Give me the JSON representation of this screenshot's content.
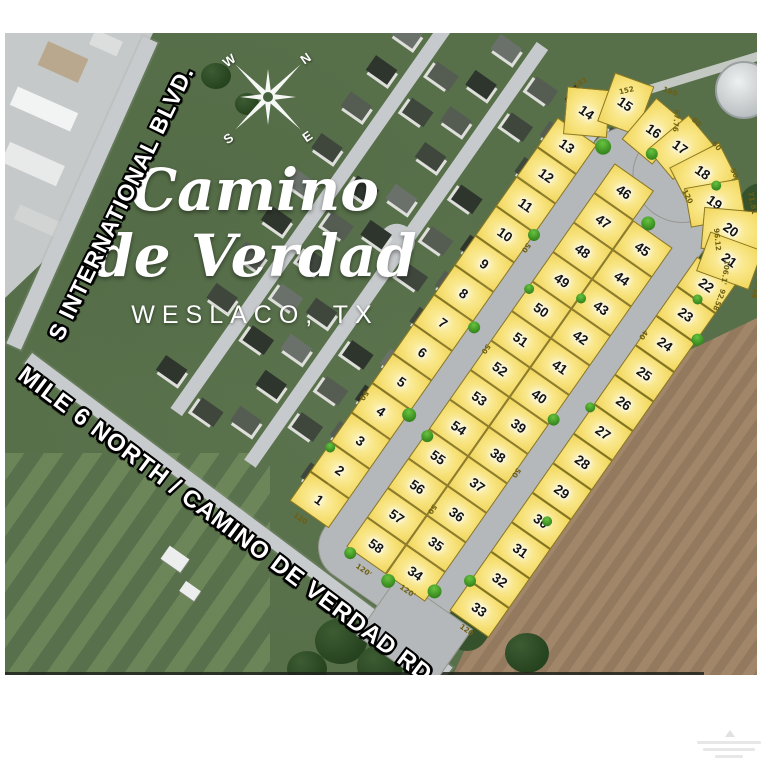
{
  "title": {
    "line1": "Camino",
    "line2": "de Verdad",
    "location": "WESLACO, TX"
  },
  "roads": {
    "blvd": "S INTERNATIONAL BLVD.",
    "main": "MILE 6 NORTH / CAMINO DE VERDAD RD."
  },
  "compass": {
    "n": "N",
    "e": "E",
    "s": "S",
    "w": "W"
  },
  "lots": {
    "outer_west": [
      "13",
      "12",
      "11",
      "10",
      "9",
      "8",
      "7",
      "6",
      "5",
      "4",
      "3",
      "2",
      "1"
    ],
    "arc": [
      "14",
      "15",
      "16",
      "17",
      "18",
      "19",
      "20",
      "21"
    ],
    "outer_east": [
      "22",
      "23",
      "24",
      "25",
      "26",
      "27",
      "28",
      "29",
      "30",
      "31",
      "32",
      "33"
    ],
    "island_west": [
      "46",
      "47",
      "48",
      "49",
      "50",
      "51",
      "52",
      "53",
      "54",
      "55",
      "56",
      "57",
      "58"
    ],
    "island_east": [
      "45",
      "44",
      "43",
      "42",
      "41",
      "40",
      "39",
      "38",
      "37",
      "36",
      "35",
      "34"
    ]
  },
  "dimensions": [
    "161",
    "152",
    "180",
    "67.76",
    "80",
    "60",
    "50",
    "120",
    "71.81",
    "96.12",
    "94.52",
    "106.1'",
    "95.58",
    "92.58",
    "120",
    "120'",
    "120'",
    "120",
    "50",
    "50",
    "50",
    "50",
    "40",
    "50"
  ],
  "colors": {
    "lot_fill": "#f8e480",
    "lot_border": "#8b7820",
    "road_gray": "#b5b8ba",
    "field_green": "#57704a",
    "field_brown": "#a1866a",
    "tree_green": "#35522c",
    "bush_green": "#3c8f22"
  }
}
